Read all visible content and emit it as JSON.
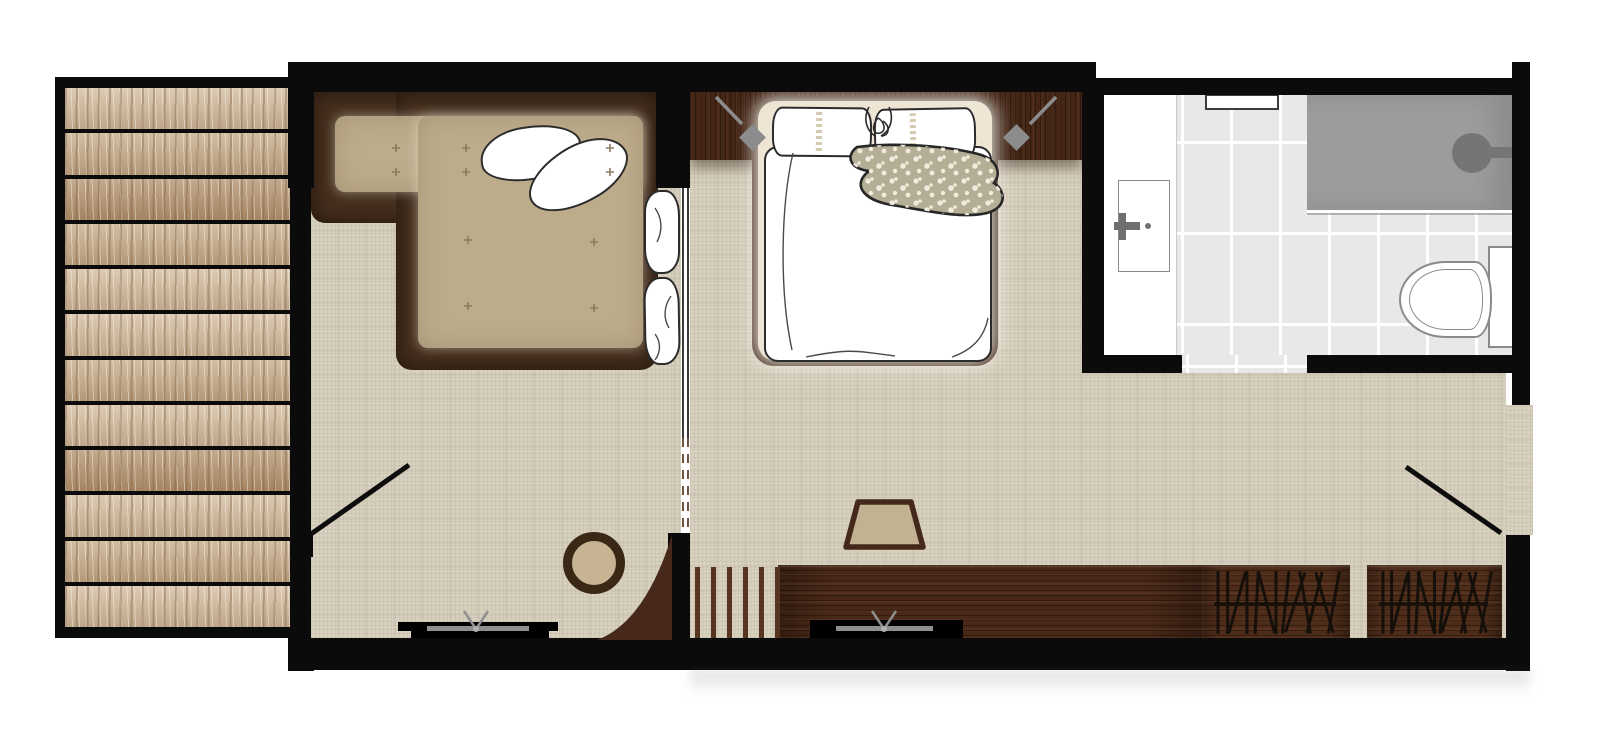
{
  "plan": {
    "type": "hotel-room-floor-plan",
    "visible_text": [],
    "colors": {
      "background": "#ffffff",
      "wall": "#0b0b0b",
      "carpet": "#d8d1c0",
      "deck_frame": "#0b0b0b",
      "plank_light": "#d3bc9e",
      "plank_mid": "#c6ab89",
      "plank_dark": "#b3926e",
      "dark_wood": "#482818",
      "headboard": "#442617",
      "sofa_frame": "#462f1e",
      "cushion": "#bdac8c",
      "tuft": "#8a7a5e",
      "outline_dark": "#2b2b2b",
      "bed_base": "#efe5d4",
      "bed_frame": "#3b2315",
      "ribbon": "#cfc5a8",
      "floral": "#b5ae96",
      "floral_dot": "#f4f0e2",
      "stool_fill": "#c3b292",
      "stool_border": "#44291a",
      "table_ring": "#3a2716",
      "table_top": "#c6b493",
      "tile": "#e8e8ea",
      "grout": "#ffffff",
      "shower": "#9c9c9c",
      "shower_head": "#757575",
      "fixture_outline": "#8a8a8a",
      "fixture_gray": "#6f6f6f",
      "tv_gray": "#8f8f8f",
      "sconce": "#8c8c8c",
      "hatch": "#16100a",
      "glass_edge": "#3a3a3a",
      "dash": "#6e5340",
      "slat": "#56341f",
      "wardrobe_wood": "#4e2c1a",
      "curve_fill": "#46291a"
    },
    "deck": {
      "plank_count": 12
    },
    "slatted_screen": {
      "slat_count": 6
    },
    "wardrobes": {
      "panel_count": 2,
      "hanger_count": 13
    },
    "sofa": {
      "tuft_count": 10,
      "pillow_count": 2,
      "bolster_count": 2
    },
    "bed": {
      "pillow_count": 2
    },
    "sconces": {
      "count": 2
    },
    "fixtures": [
      "wood-deck-terrace",
      "terrace-door",
      "l-shaped-sofa",
      "sofa-pillows",
      "round-side-table",
      "tv-living",
      "curved-corner-unit",
      "sliding-glass-partition",
      "double-bed",
      "wall-sconce-left",
      "wall-sconce-right",
      "floral-throw",
      "stool",
      "slatted-screen",
      "tv-console-bedroom",
      "wardrobe-hanger-panels",
      "vanity-counter",
      "sink-basin",
      "wall-niche",
      "walk-in-shower",
      "shower-head",
      "toilet",
      "entry-door"
    ]
  }
}
